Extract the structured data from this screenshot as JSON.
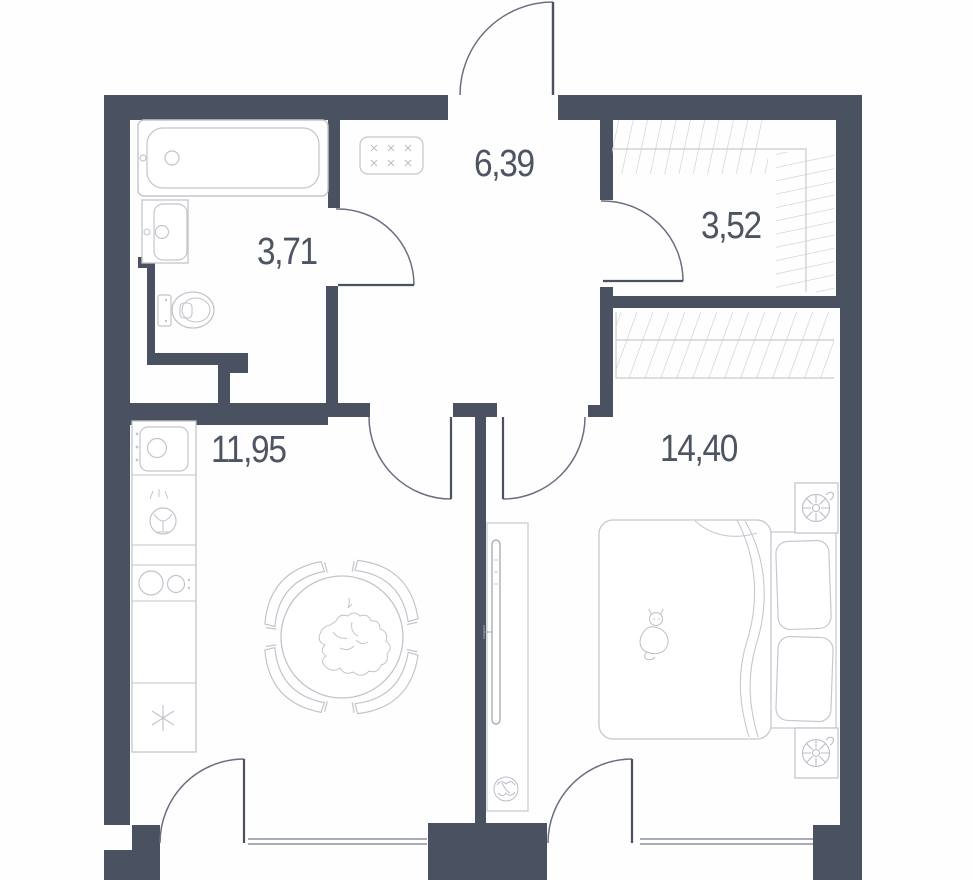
{
  "plan_title": "Apartment floor plan",
  "areas": {
    "hallway": "6,39",
    "wardrobe": "3,52",
    "bathroom": "3,71",
    "kitchen_living": "11,95",
    "bedroom": "14,40"
  },
  "rooms": [
    {
      "key": "hallway",
      "area": "6,39"
    },
    {
      "key": "wardrobe",
      "area": "3,52"
    },
    {
      "key": "bathroom",
      "area": "3,71"
    },
    {
      "key": "kitchen_living",
      "area": "11,95"
    },
    {
      "key": "bedroom",
      "area": "14,40"
    }
  ],
  "colors": {
    "wall": "#4a5160",
    "furniture_line": "#c5c8cf",
    "door_line": "#6a7080",
    "window_line": "#8a90a0",
    "hatch": "#c8cbd2",
    "text": "#4d5462",
    "background": "#fefefe"
  },
  "fixtures": [
    "entrance-door",
    "bathroom-door",
    "wardrobe-door",
    "living-room-door",
    "bedroom-door",
    "balcony-door-living",
    "balcony-door-bedroom",
    "window-living",
    "window-bedroom",
    "bathtub",
    "bathroom-sink",
    "toilet",
    "electrical-panel",
    "kitchen-sink",
    "washing-machine",
    "hob",
    "refrigerator",
    "dining-table",
    "chair",
    "flower-bouquet",
    "tv-console",
    "tv",
    "plant",
    "bed",
    "pillow",
    "duvet",
    "cat-print",
    "radiator",
    "wardrobe-hatching"
  ]
}
